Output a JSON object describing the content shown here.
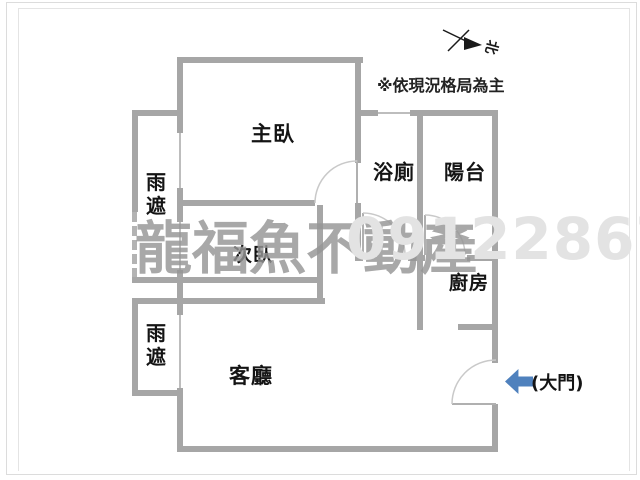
{
  "plan_note": "※依現況格局為主",
  "north_label": "北",
  "rooms": {
    "master_bedroom": "主臥",
    "bathroom": "浴廁",
    "balcony": "陽台",
    "rain_canopy_upper": "雨遮",
    "rain_canopy_lower": "雨遮",
    "second_bedroom": "次臥",
    "living_room": "客廳",
    "kitchen": "廚房"
  },
  "entrance": {
    "label": "(大門)",
    "arrow_color": "#4f81bd"
  },
  "watermark": {
    "line1": "龍福魚不動產",
    "line2": "0912286720"
  },
  "colors": {
    "wall": "#a6a6a6",
    "window": "#bdbdbd",
    "door_arc": "#c9c9c9",
    "label_text": "#141414",
    "watermark_dark": "#969696",
    "watermark_light": "#e3e3e3",
    "frame": "#dcdcdc"
  }
}
